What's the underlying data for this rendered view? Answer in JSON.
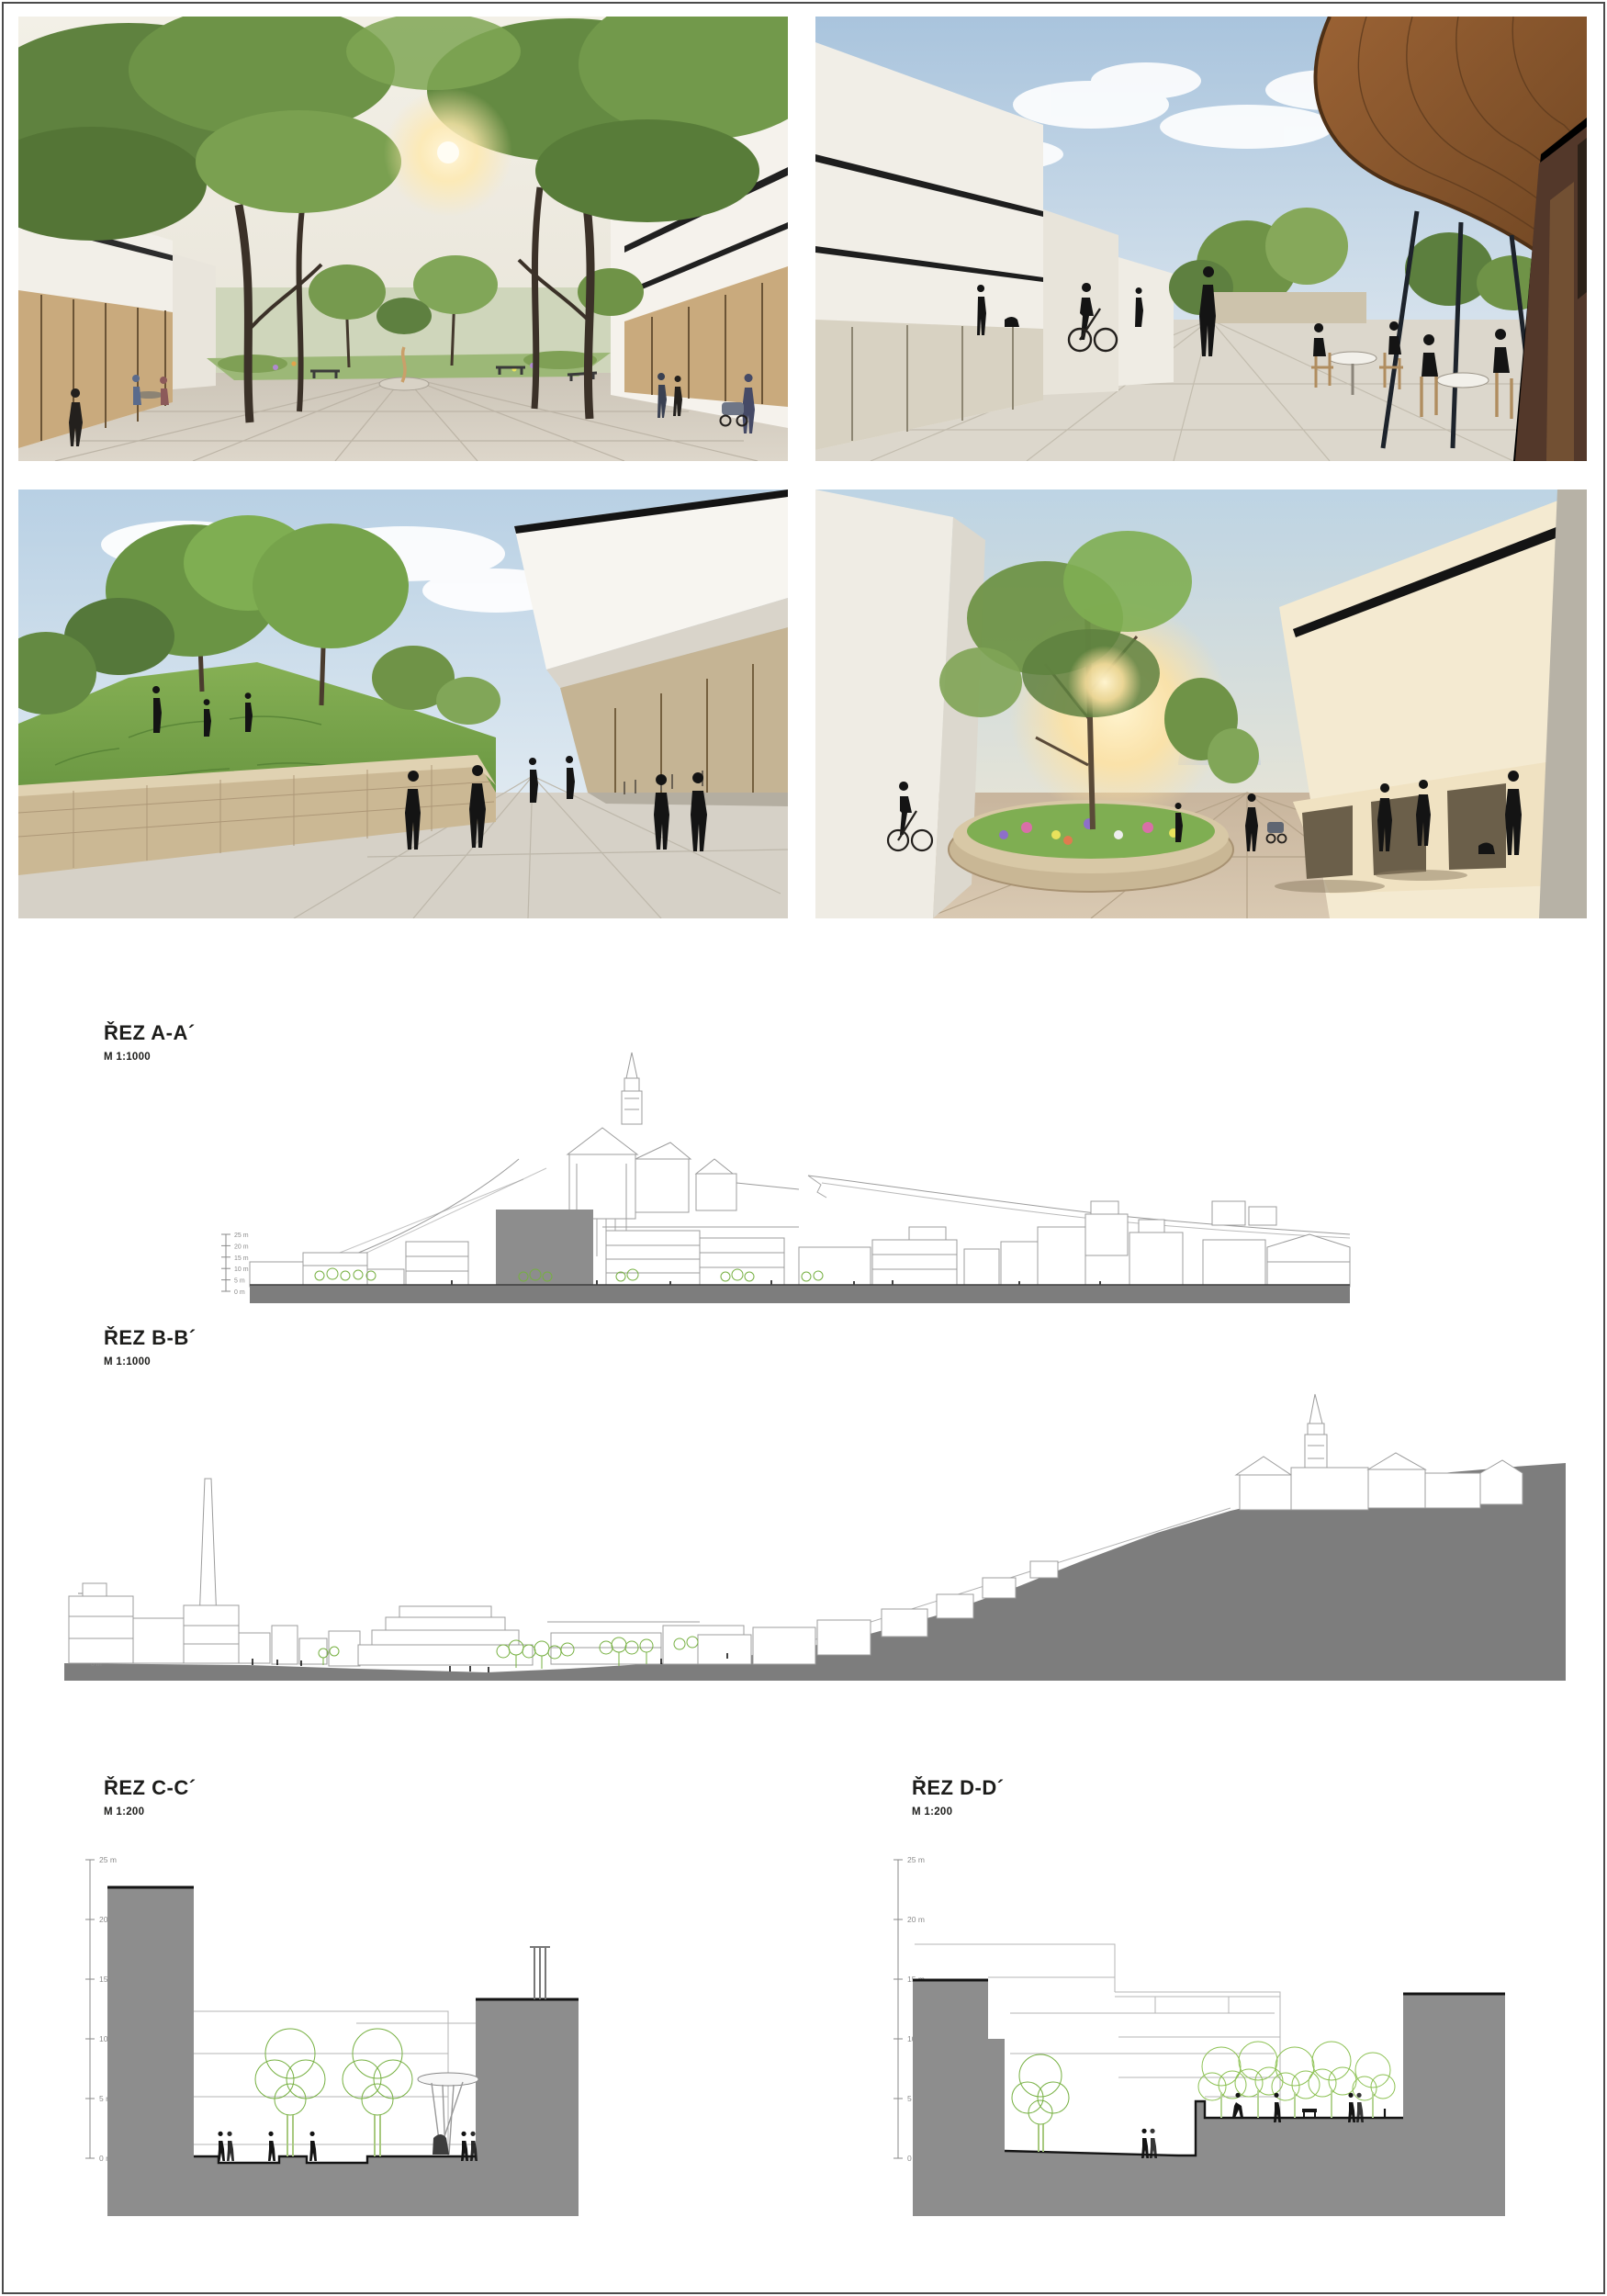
{
  "ticks": [
    "25 m",
    "20 m",
    "15 m",
    "10 m",
    "5 m",
    "0 m"
  ],
  "sections": {
    "a": {
      "title": "ŘEZ A-A´",
      "scale": "M 1:1000"
    },
    "b": {
      "title": "ŘEZ B-B´",
      "scale": "M 1:1000"
    },
    "c": {
      "title": "ŘEZ C-C´",
      "scale": "M 1:200"
    },
    "d": {
      "title": "ŘEZ D-D´",
      "scale": "M 1:200"
    }
  },
  "colors": {
    "section_ground": "#7d7d7d",
    "section_massing": "#8d8d8d",
    "sketch_line": "#9c9c9c",
    "tree_green": "#76b041",
    "label_text": "#1d1d1b"
  }
}
